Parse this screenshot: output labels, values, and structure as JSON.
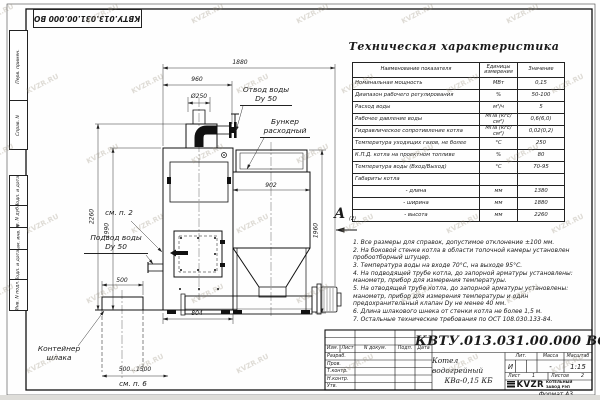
{
  "watermark": "KVZR.RU",
  "corner_doc_number": "КВТУ.013.031.00.000 ВО",
  "margin_stamps": [
    "Перв. примен.",
    "Справ. N",
    "Подп. и дата",
    "Инв. N дубл.",
    "Взам. инв. N",
    "Подп. и дата",
    "Инв. N подл."
  ],
  "spec_table": {
    "title": "Техническая характеристика",
    "headers": [
      "Наименование показателя",
      "Единицы измерения",
      "Значение"
    ],
    "rows": [
      [
        "Номинальная мощность",
        "МВт",
        "0,15"
      ],
      [
        "Диапазон рабочего регулирования",
        "%",
        "50-100"
      ],
      [
        "Расход воды",
        "м³/ч",
        "5"
      ],
      [
        "Рабочее давление воды",
        "МПа (кгс/см²)",
        "0,6(6,0)"
      ],
      [
        "Гидравлическое сопротивление котла",
        "МПа (кгс/см²)",
        "0,02(0,2)"
      ],
      [
        "Температура уходящих газов, не более",
        "°С",
        "250"
      ],
      [
        "К.П.Д. котла на проектном топливе",
        "%",
        "80"
      ],
      [
        "Температура воды (Вход/Выход)",
        "°С",
        "70-95"
      ],
      [
        "Габариты котла",
        "",
        ""
      ],
      [
        "- длина",
        "мм",
        "1380"
      ],
      [
        "- ширина",
        "мм",
        "1880"
      ],
      [
        "- высота",
        "мм",
        "2260"
      ]
    ]
  },
  "view_marker": {
    "letter": "А",
    "ref": "(2)"
  },
  "notes": [
    "1. Все размеры для справок, допустимое отклонение ±100 мм.",
    "2. На боковой стенке котла в области топочной камеры установлен пробоотборный штуцер.",
    "3. Температура воды на входе 70°С, на выходе 95°С.",
    "4. На подводящей трубе котла, до запорной арматуры установлены: манометр, прибор для измерения температуры.",
    "5. На отводящей трубе котла, до запорной арматуры установлены: манометр, прибор для измерения температуры и один предохранительный клапан Dу не менее 40 мм.",
    "6. Длина шлакового шнека от стенки котла не более 1,5 м.",
    "7. Остальные технические требования по ОСТ 108.030.133-84."
  ],
  "dimensions": {
    "d1880": "1880",
    "d960": "960",
    "d250": "Ø250",
    "d2260": "2260",
    "d1990": "1990",
    "d500": "500",
    "d902": "902",
    "d1960": "1960",
    "d804": "804",
    "d500_1500": "500...1500",
    "see2": "см. п. 2",
    "see6": "см. п. 6"
  },
  "labels": {
    "outlet1": "Отвод воды",
    "outlet2": "Dy 50",
    "bunker1": "Бункер",
    "bunker2": "расходный",
    "inlet1": "Подвод воды",
    "inlet2": "Dy 50",
    "slag1": "Контейнер",
    "slag2": "шлака"
  },
  "title_block": {
    "doc_number": "КВТУ.013.031.00.000  ВО",
    "product_name_1": "Котел водогрейный",
    "product_name_2": "КВа-0,15  КБ",
    "header_cols": [
      "Изм.",
      "Лист",
      "N докум.",
      "Подп.",
      "Дата"
    ],
    "roles": [
      "Разраб.",
      "Пров.",
      "Т.контр.",
      "Н.контр.",
      "Утв."
    ],
    "lit_header": "Лит.",
    "mass_header": "Масса",
    "scale_header": "Масштаб",
    "lit": "И",
    "mass": "-",
    "scale": "1:15",
    "sheet_label": "Лист",
    "sheet_value": "1",
    "sheets_label": "Листов",
    "sheets_value": "2",
    "logo_text": "KVZR",
    "logo_sub1": "КОТЕЛЬНЫЙ",
    "logo_sub2": "ЗАВОД РЭП",
    "format": "Формат А3"
  }
}
